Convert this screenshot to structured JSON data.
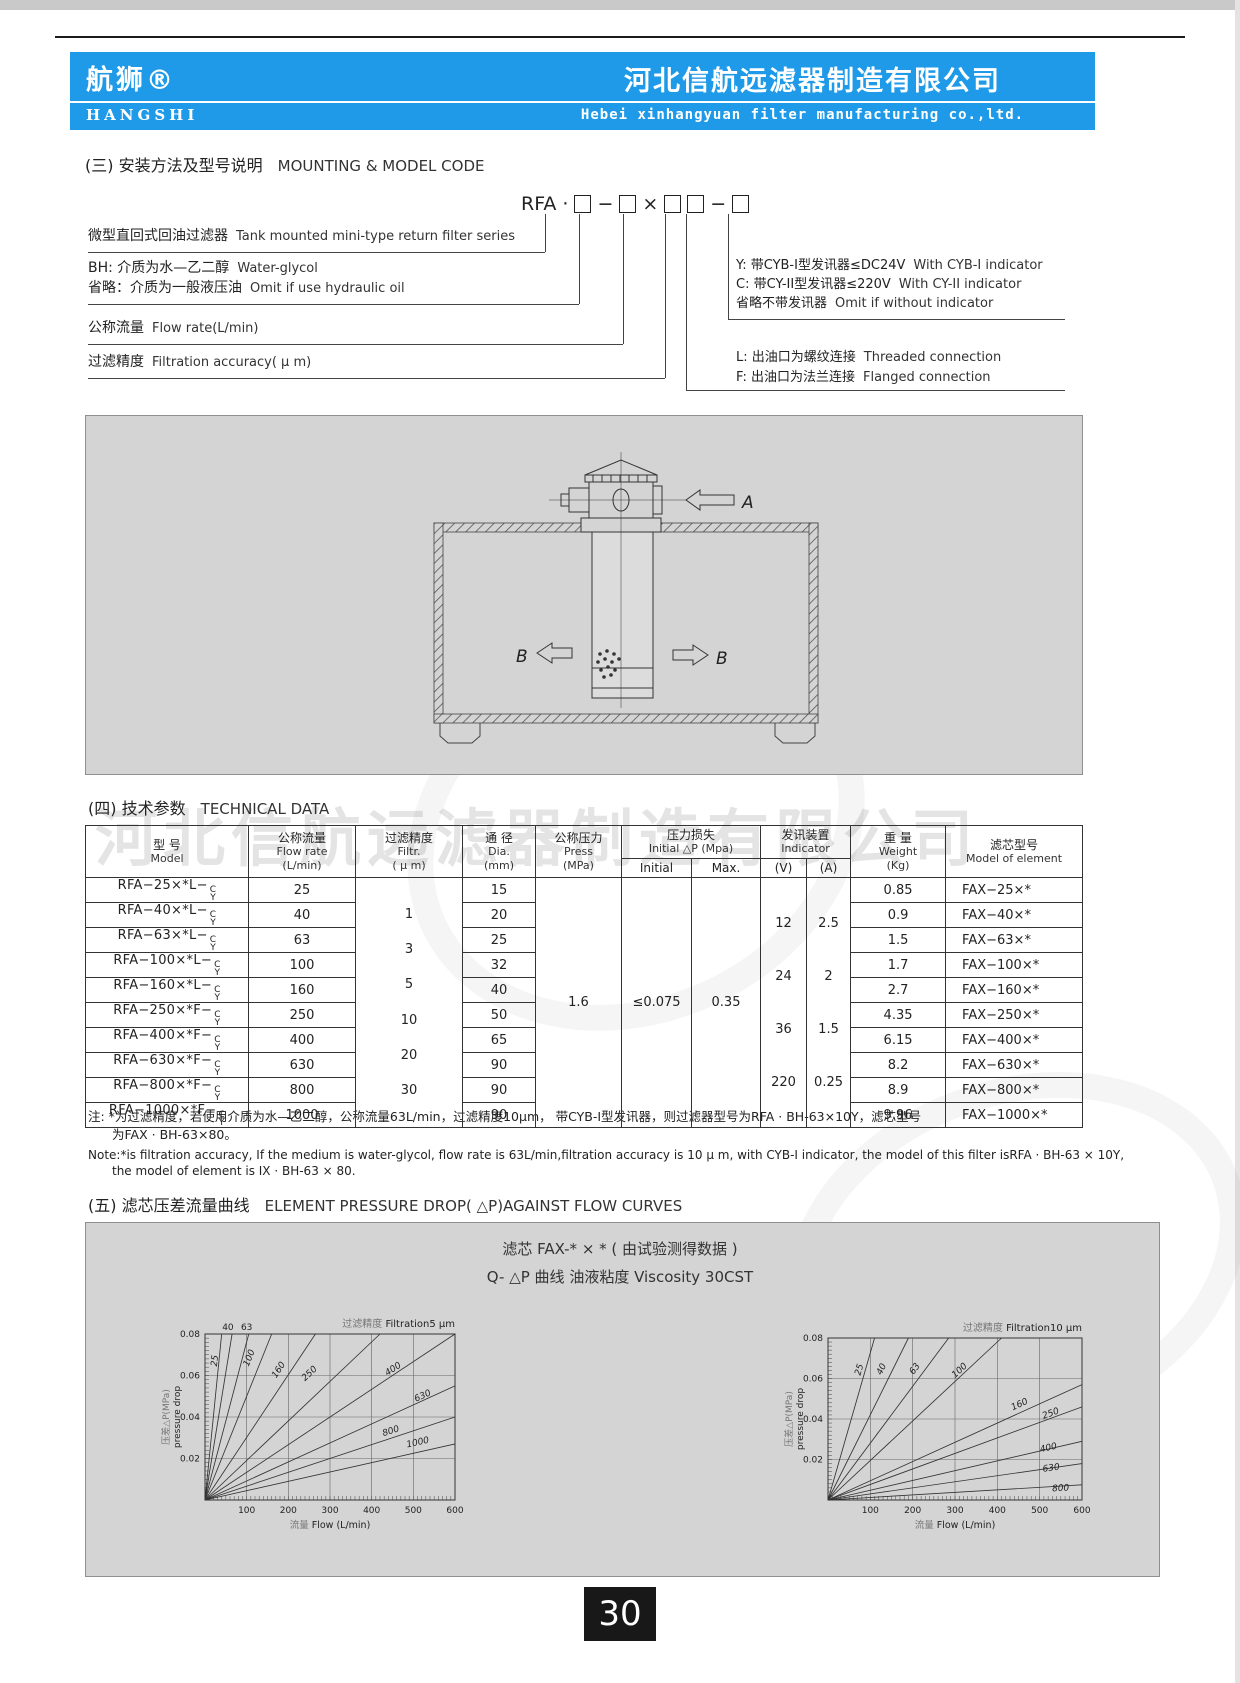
{
  "page": {
    "number": "30"
  },
  "header": {
    "banner_color": "#1e9ae8",
    "brand_cn": "航狮®",
    "brand_en": "HANGSHI",
    "company_cn": "河北信航远滤器制造有限公司",
    "company_en": "Hebei xinhangyuan filter manufacturing co.,ltd."
  },
  "section3": {
    "heading_cn": "(三) 安装方法及型号说明",
    "heading_en": "MOUNTING & MODEL CODE",
    "code": {
      "prefix": "RFA",
      "dot": "·",
      "dash1": "−",
      "times": "×",
      "dash2": "−"
    },
    "left_rows": [
      {
        "cn": "微型直回式回油过滤器",
        "en": "Tank mounted mini-type return filter series"
      },
      {
        "cn": "BH: 介质为水—乙二醇",
        "en": "Water-glycol"
      },
      {
        "cn": "省略：介质为一般液压油",
        "en": "Omit if use hydraulic oil"
      },
      {
        "cn": "公称流量",
        "en": "Flow rate(L/min)"
      },
      {
        "cn": "过滤精度",
        "en": "Filtration accuracy( μ m)"
      }
    ],
    "right_rows": [
      {
        "cn": "Y: 带CYB-I型发讯器≤DC24V",
        "en": "With CYB-I indicator"
      },
      {
        "cn": "C: 带CY-II型发讯器≤220V",
        "en": "With CY-II indicator"
      },
      {
        "cn": "省略不带发讯器",
        "en": "Omit if without indicator"
      },
      {
        "cn": "L: 出油口为螺纹连接",
        "en": "Threaded connection"
      },
      {
        "cn": "F: 出油口为法兰连接",
        "en": "Flanged connection"
      }
    ]
  },
  "diagram": {
    "label_a": "A",
    "label_b_left": "B",
    "label_b_right": "B"
  },
  "section4": {
    "heading_cn": "(四) 技术参数",
    "heading_en": "TECHNICAL DATA",
    "table": {
      "headers": {
        "model_cn": "型 号",
        "model_en": "Model",
        "flow_cn": "公称流量",
        "flow_en": "Flow rate",
        "flow_unit": "(L/min)",
        "filtr_cn": "过滤精度",
        "filtr_en": "Filtr.",
        "filtr_unit": "( μ m)",
        "dia_cn": "通 径",
        "dia_en": "Dia.",
        "dia_unit": "(mm)",
        "press_cn": "公称压力",
        "press_en": "Press",
        "press_unit": "(MPa)",
        "dp_cn": "压力损失",
        "dp_en": "Initial △P (Mpa)",
        "dp_sub1": "Initial",
        "dp_sub2": "Max.",
        "ind_cn": "发讯装置",
        "ind_en": "Indicator",
        "ind_sub1": "(V)",
        "ind_sub2": "(A)",
        "weight_cn": "重 量",
        "weight_en": "Weight",
        "weight_unit": "(Kg)",
        "element_cn": "滤芯型号",
        "element_en": "Model of element"
      },
      "suffix": {
        "top": "C",
        "bottom": "Y"
      },
      "rows": [
        {
          "model": "RFA−25×*L−",
          "flow": "25",
          "dia": "15",
          "weight": "0.85",
          "element": "FAX−25×*"
        },
        {
          "model": "RFA−40×*L−",
          "flow": "40",
          "dia": "20",
          "weight": "0.9",
          "element": "FAX−40×*"
        },
        {
          "model": "RFA−63×*L−",
          "flow": "63",
          "dia": "25",
          "weight": "1.5",
          "element": "FAX−63×*"
        },
        {
          "model": "RFA−100×*L−",
          "flow": "100",
          "dia": "32",
          "weight": "1.7",
          "element": "FAX−100×*"
        },
        {
          "model": "RFA−160×*L−",
          "flow": "160",
          "dia": "40",
          "weight": "2.7",
          "element": "FAX−160×*"
        },
        {
          "model": "RFA−250×*F−",
          "flow": "250",
          "dia": "50",
          "weight": "4.35",
          "element": "FAX−250×*"
        },
        {
          "model": "RFA−400×*F−",
          "flow": "400",
          "dia": "65",
          "weight": "6.15",
          "element": "FAX−400×*"
        },
        {
          "model": "RFA−630×*F−",
          "flow": "630",
          "dia": "90",
          "weight": "8.2",
          "element": "FAX−630×*"
        },
        {
          "model": "RFA−800×*F−",
          "flow": "800",
          "dia": "90",
          "weight": "8.9",
          "element": "FAX−800×*"
        },
        {
          "model": "RFA−1000×*F−",
          "flow": "1000",
          "dia": "90",
          "weight": "9.96",
          "element": "FAX−1000×*"
        }
      ],
      "filtration_values": [
        "1",
        "3",
        "5",
        "10",
        "20",
        "30"
      ],
      "press": "1.6",
      "dp_initial": "≤0.075",
      "dp_max": "0.35",
      "indicator_v": [
        "12",
        "24",
        "36",
        "220"
      ],
      "indicator_a": [
        "2.5",
        "2",
        "1.5",
        "0.25"
      ]
    },
    "note_cn_1": "注: *为过滤精度，若使用介质为水—乙二醇，公称流量63L/min，过滤精度10μm， 带CYB-I型发讯器，则过滤器型号为RFA · BH-63×10Y，滤芯型号",
    "note_cn_2": "为FAX · BH-63×80。",
    "note_en_1": "Note:*is filtration accuracy, If the medium is water-glycol, flow rate is 63L/min,filtration accuracy is 10 μ m, with CYB-I indicator, the model of this  filter isRFA · BH-63 × 10Y,",
    "note_en_2": "the model of element is IX · BH-63 × 80."
  },
  "section5": {
    "heading_cn": "(五) 滤芯压差流量曲线",
    "heading_en": "ELEMENT PRESSURE DROP( △P)AGAINST FLOW CURVES",
    "panel_title_line1": "滤芯 FAX-* × * ( 由试验测得数据 )",
    "panel_title_line2": "Q- △P 曲线 油液粘度 Viscosity 30CST"
  },
  "watermark": "河北信航远滤器制造有限公司",
  "chart_data": [
    {
      "type": "line",
      "title_cn": "过滤精度",
      "title_en": "Filtration5  μm",
      "xlabel_cn": "流量",
      "xlabel_en": "Flow  (L/min)",
      "ylabel_cn": "压差△P(MPa)",
      "ylabel_en": "pressure drop",
      "xlim": [
        0,
        600
      ],
      "ylim": [
        0,
        0.08
      ],
      "xticks": [
        100,
        200,
        300,
        400,
        500,
        600
      ],
      "yticks": [
        0.02,
        0.04,
        0.06,
        0.08
      ],
      "grid": true,
      "legend": "labels-on-curves",
      "series": [
        {
          "name": "25",
          "end": [
            40,
            0.08
          ],
          "label": [
            30,
            0.067
          ]
        },
        {
          "name": "40",
          "end": [
            65,
            0.08
          ],
          "label": [
            55,
            0.0835
          ],
          "above": true
        },
        {
          "name": "63",
          "end": [
            105,
            0.08
          ],
          "label": [
            100,
            0.0835
          ],
          "above": true
        },
        {
          "name": "100",
          "end": [
            160,
            0.08
          ],
          "label": [
            112,
            0.068
          ]
        },
        {
          "name": "160",
          "end": [
            265,
            0.08
          ],
          "label": [
            182,
            0.062
          ]
        },
        {
          "name": "250",
          "end": [
            420,
            0.08
          ],
          "label": [
            255,
            0.06
          ]
        },
        {
          "name": "400",
          "end": [
            600,
            0.08
          ],
          "label": [
            455,
            0.062
          ]
        },
        {
          "name": "630",
          "end": [
            600,
            0.055
          ],
          "label": [
            525,
            0.049
          ]
        },
        {
          "name": "800",
          "end": [
            600,
            0.04
          ],
          "label": [
            448,
            0.032
          ]
        },
        {
          "name": "1000",
          "end": [
            600,
            0.027
          ],
          "label": [
            512,
            0.0265
          ]
        }
      ]
    },
    {
      "type": "line",
      "title_cn": "过滤精度",
      "title_en": "Filtration10  μm",
      "xlabel_cn": "流量",
      "xlabel_en": "Flow  (L/min)",
      "ylabel_cn": "压差△P(MPa)",
      "ylabel_en": "pressure drop",
      "xlim": [
        0,
        600
      ],
      "ylim": [
        0,
        0.08
      ],
      "xticks": [
        100,
        200,
        300,
        400,
        500,
        600
      ],
      "yticks": [
        0.02,
        0.04,
        0.06,
        0.08
      ],
      "grid": true,
      "legend": "labels-on-curves",
      "series": [
        {
          "name": "25",
          "end": [
            110,
            0.08
          ],
          "label": [
            80,
            0.064
          ]
        },
        {
          "name": "40",
          "end": [
            190,
            0.08
          ],
          "label": [
            132,
            0.064
          ]
        },
        {
          "name": "63",
          "end": [
            285,
            0.08
          ],
          "label": [
            210,
            0.064
          ]
        },
        {
          "name": "100",
          "end": [
            410,
            0.08
          ],
          "label": [
            315,
            0.063
          ]
        },
        {
          "name": "160",
          "end": [
            600,
            0.057
          ],
          "label": [
            455,
            0.046
          ]
        },
        {
          "name": "250",
          "end": [
            600,
            0.046
          ],
          "label": [
            528,
            0.0415
          ]
        },
        {
          "name": "400",
          "end": [
            600,
            0.029
          ],
          "label": [
            522,
            0.0245
          ]
        },
        {
          "name": "630",
          "end": [
            600,
            0.018
          ],
          "label": [
            528,
            0.0145
          ]
        },
        {
          "name": "800",
          "end": [
            600,
            0.0075
          ],
          "label": [
            550,
            0.0045
          ]
        }
      ]
    }
  ]
}
